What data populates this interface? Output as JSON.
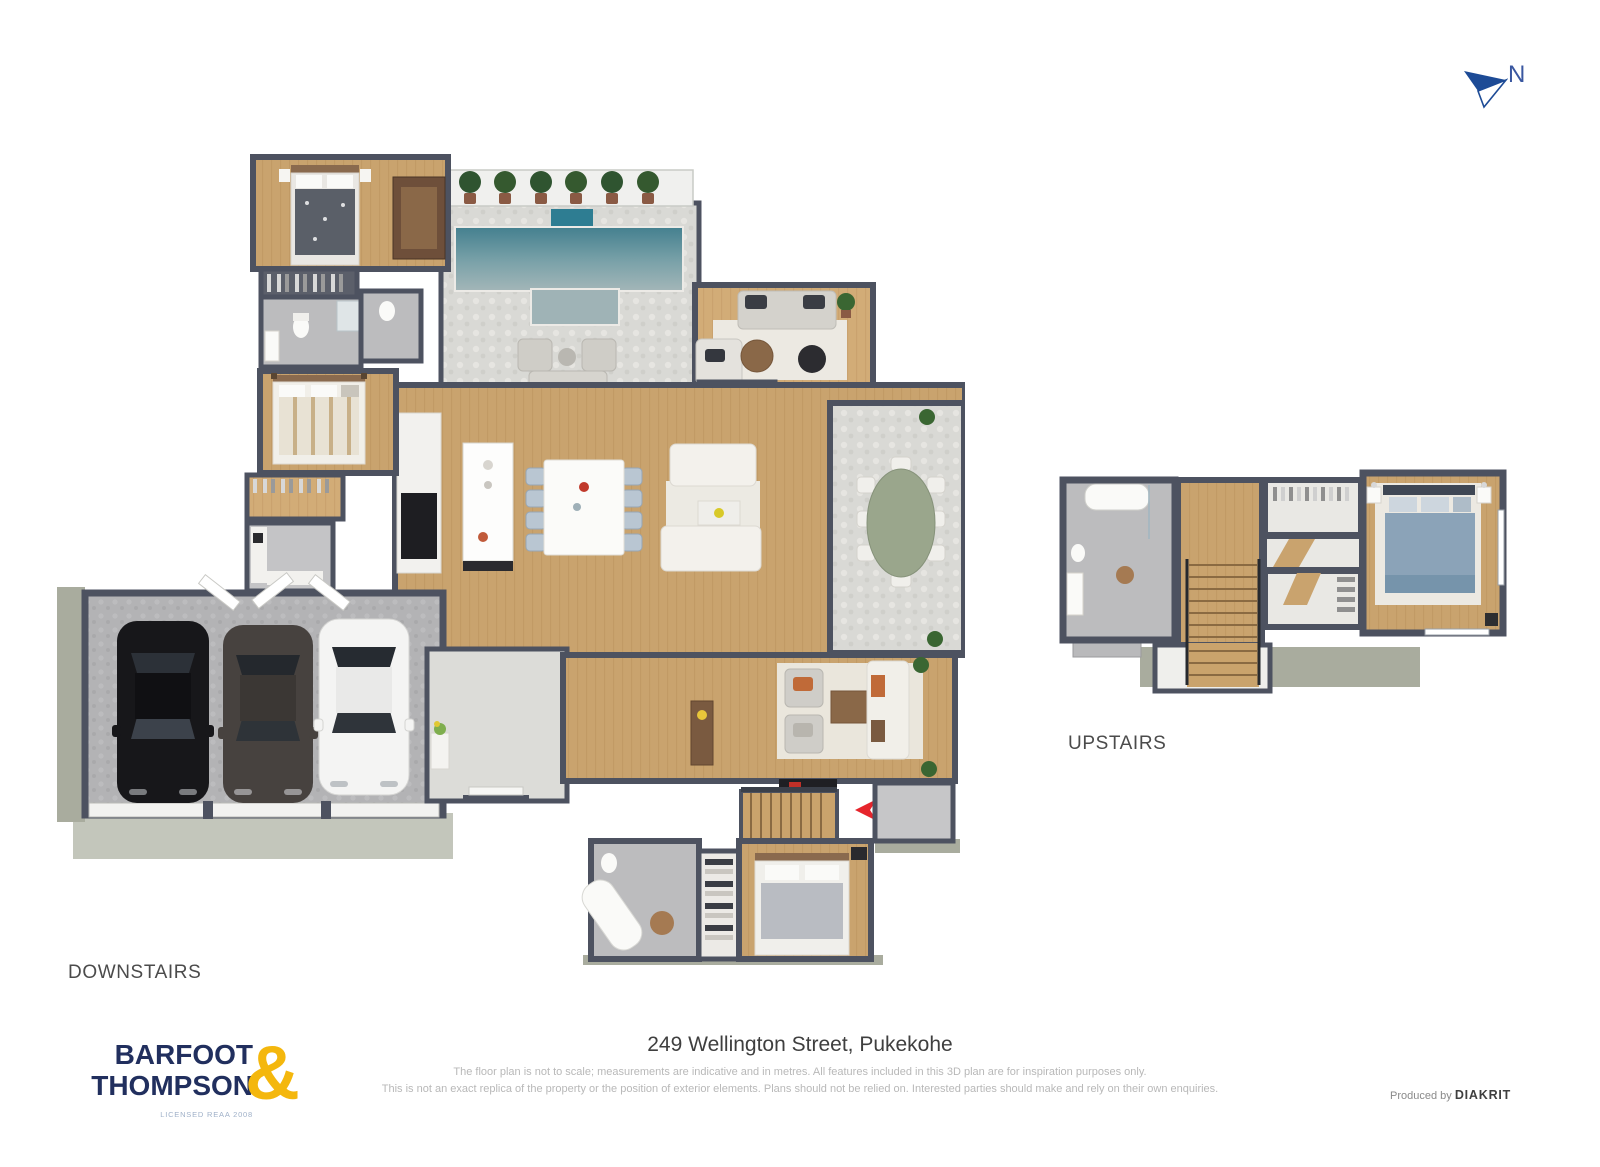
{
  "north": {
    "label": "N"
  },
  "plan_labels": {
    "downstairs": "DOWNSTAIRS",
    "upstairs": "UPSTAIRS"
  },
  "footer": {
    "logo": {
      "name_line1": "BARFOOT",
      "name_line2": "THOMPSON",
      "ampersand": "&",
      "license": "LICENSED REAA 2008"
    },
    "address": "249 Wellington Street, Pukekohe",
    "disclaimer_line1": "The floor plan is not to scale; measurements are indicative and in metres. All features included in this 3D plan are for inspiration purposes only.",
    "disclaimer_line2": "This is not an exact replica of the property or the position of exterior elements. Plans should not be relied on. Interested parties should make and rely on their own enquiries.",
    "produced_by_prefix": "Produced by ",
    "producer": "DIAKRIT"
  },
  "colors": {
    "logo_navy": "#212f5e",
    "logo_gold": "#f4b70d",
    "north_arrow_blue": "#1d4b96",
    "entry_arrow_red": "#e6252c",
    "wall": "#4d5260",
    "wood_floor": "#c9a36e",
    "stone_floor": "#d9d9d5",
    "concrete_floor": "#b3b3b5",
    "pool_water": "#44808f",
    "slab_edge": "#a9ac9e"
  }
}
